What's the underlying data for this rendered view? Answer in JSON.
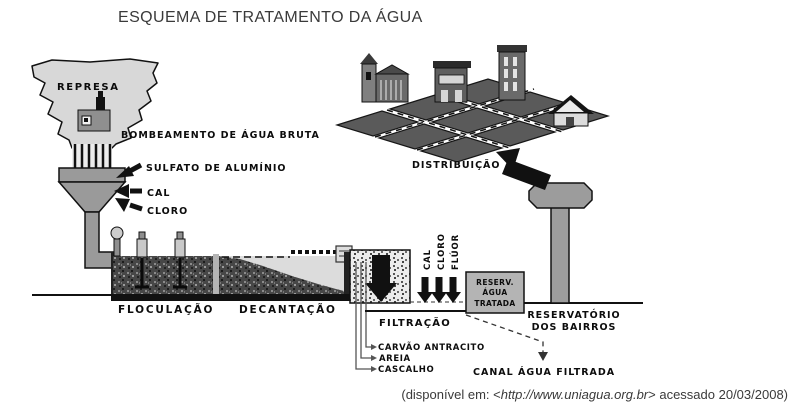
{
  "title": "ESQUEMA DE TRATAMENTO DA ÁGUA",
  "diagram": {
    "represa": "REPRESA",
    "bombeamento": "BOMBEAMENTO DE ÁGUA BRUTA",
    "dosing_funnel": {
      "sulfato": "SULFATO DE ALUMÍNIO",
      "cal": "CAL",
      "cloro": "CLORO"
    },
    "stages": {
      "floculacao": "FLOCULAÇÃO",
      "decantacao": "DECANTAÇÃO",
      "filtracao": "FILTRAÇÃO",
      "distribuicao": "DISTRIBUIÇÃO"
    },
    "filter_layers": {
      "carvao": "CARVÃO ANTRACITO",
      "areia": "AREIA",
      "cascalho": "CASCALHO"
    },
    "dosing_channel": {
      "cal": "CAL",
      "cloro": "CLORO",
      "fluor": "FLÚOR"
    },
    "treated_box": {
      "line1": "RESERV.",
      "line2": "ÁGUA",
      "line3": "TRATADA"
    },
    "reservatorio": {
      "line1": "RESERVATÓRIO",
      "line2": "DOS BAIRROS"
    },
    "canal": "CANAL ÁGUA FILTRADA"
  },
  "source": {
    "prefix": "(disponível em: <",
    "url": "http://www.uniagua.org.br",
    "suffix": "> acessado 20/03/2008)"
  },
  "colors": {
    "represa_fill": "#d8d8d8",
    "funnel_fill": "#9a9a9a",
    "city_block_fill": "#5a5a5a",
    "water_fill": "#dcdcdc",
    "treated_box_fill": "#b4b4b4",
    "tower_fill": "#9c9c9c",
    "ink": "#111111"
  }
}
